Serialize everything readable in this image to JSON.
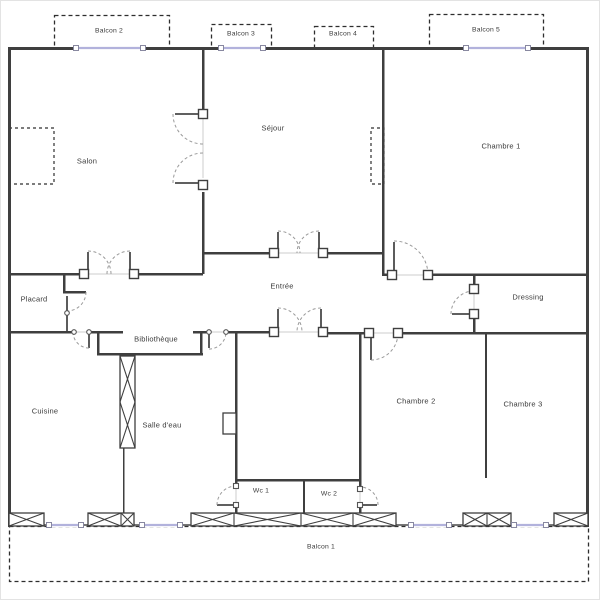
{
  "title": "Plan d'appartement",
  "plan": {
    "colors": {
      "wall": "#3f3f3f",
      "window_blue": "#b2b2dc",
      "dash": "#2e2e2e",
      "arc": "#9a9a9a",
      "thin_opening": "#cccccc",
      "door_leaf": "#4a4a4a",
      "label": "#3a3a3a",
      "jamb_border": "#555555",
      "window_square_border": "#8888a0"
    },
    "labels": [
      {
        "id": "balcon-2",
        "text": "Balcon 2",
        "x": 108,
        "y": 30,
        "small": true
      },
      {
        "id": "balcon-3",
        "text": "Balcon 3",
        "x": 240,
        "y": 33,
        "small": true
      },
      {
        "id": "balcon-4",
        "text": "Balcon 4",
        "x": 342,
        "y": 33,
        "small": true
      },
      {
        "id": "balcon-5",
        "text": "Balcon 5",
        "x": 485,
        "y": 29,
        "small": true
      },
      {
        "id": "salon",
        "text": "Salon",
        "x": 86,
        "y": 160,
        "small": false
      },
      {
        "id": "sejour",
        "text": "Séjour",
        "x": 272,
        "y": 127,
        "small": false
      },
      {
        "id": "chambre-1",
        "text": "Chambre 1",
        "x": 500,
        "y": 145,
        "small": false
      },
      {
        "id": "entree",
        "text": "Entrée",
        "x": 281,
        "y": 285,
        "small": false
      },
      {
        "id": "placard",
        "text": "Placard",
        "x": 33,
        "y": 298,
        "small": false
      },
      {
        "id": "dressing",
        "text": "Dressing",
        "x": 527,
        "y": 296,
        "small": false
      },
      {
        "id": "bibliotheque",
        "text": "Bibliothèque",
        "x": 155,
        "y": 338,
        "small": false
      },
      {
        "id": "cuisine",
        "text": "Cuisine",
        "x": 44,
        "y": 410,
        "small": false
      },
      {
        "id": "salle-deau",
        "text": "Salle d'eau",
        "x": 161,
        "y": 424,
        "small": false
      },
      {
        "id": "chambre-2",
        "text": "Chambre 2",
        "x": 415,
        "y": 400,
        "small": false
      },
      {
        "id": "chambre-3",
        "text": "Chambre 3",
        "x": 522,
        "y": 403,
        "small": false
      },
      {
        "id": "wc-1",
        "text": "Wc 1",
        "x": 260,
        "y": 490,
        "small": true
      },
      {
        "id": "wc-2",
        "text": "Wc 2",
        "x": 328,
        "y": 493,
        "small": true
      },
      {
        "id": "balcon-1",
        "text": "Balcon 1",
        "x": 320,
        "y": 546,
        "small": true
      }
    ],
    "balconies": [
      {
        "id": "balcon-2",
        "x": 53,
        "y": 14,
        "w": 115,
        "h": 33
      },
      {
        "id": "balcon-3",
        "x": 210,
        "y": 23,
        "w": 60,
        "h": 24
      },
      {
        "id": "balcon-4",
        "x": 313,
        "y": 25,
        "w": 59,
        "h": 22
      },
      {
        "id": "balcon-5",
        "x": 428,
        "y": 13,
        "w": 114,
        "h": 34
      },
      {
        "id": "balcon-1",
        "x": 8,
        "y": 525,
        "w": 579,
        "h": 55
      }
    ],
    "dashed_feature_boxes": [
      [
        8,
        127,
        45,
        56
      ],
      [
        370,
        127,
        13,
        56
      ]
    ],
    "solid_boxes": [
      [
        222,
        412,
        13,
        21
      ]
    ],
    "walls": [
      [
        8,
        46,
        580,
        3
      ],
      [
        7,
        46,
        3,
        480
      ],
      [
        585,
        46,
        3,
        480
      ],
      [
        201,
        47,
        2.5,
        61
      ],
      [
        201,
        191,
        2.5,
        82
      ],
      [
        381,
        47,
        2.5,
        228
      ],
      [
        202,
        251,
        71,
        2.5
      ],
      [
        322,
        251,
        60,
        2.5
      ],
      [
        8,
        272,
        75,
        2.5
      ],
      [
        133,
        272,
        69,
        2.5
      ],
      [
        382,
        272.5,
        9,
        2.5
      ],
      [
        427,
        272.5,
        160,
        2.5
      ],
      [
        472,
        274,
        2.5,
        14
      ],
      [
        472,
        313,
        2.5,
        19
      ],
      [
        397,
        331,
        190,
        2.5
      ],
      [
        327,
        331,
        41,
        2.5
      ],
      [
        484,
        332,
        2,
        145
      ],
      [
        8,
        330,
        65,
        2.5
      ],
      [
        88,
        330,
        34,
        2.5
      ],
      [
        96,
        331,
        2.5,
        23
      ],
      [
        96,
        352,
        106,
        2.5
      ],
      [
        199,
        331,
        2.5,
        22
      ],
      [
        192,
        330,
        16,
        2.5
      ],
      [
        225,
        330,
        48,
        2.5
      ],
      [
        62,
        273,
        2.5,
        19
      ],
      [
        62,
        290,
        23,
        2.5
      ],
      [
        234,
        331,
        2.5,
        154
      ],
      [
        234,
        504,
        2.5,
        20
      ],
      [
        234,
        478,
        126,
        2.5
      ],
      [
        358,
        332,
        2.5,
        156
      ],
      [
        358,
        504,
        2.5,
        20
      ],
      [
        302,
        479,
        2,
        45
      ],
      [
        122,
        447,
        1.5,
        77
      ]
    ],
    "thin_openings": [
      [
        202,
        118,
        202,
        177
      ],
      [
        87,
        273,
        129,
        273
      ],
      [
        277,
        252,
        318,
        252
      ],
      [
        277,
        331,
        320,
        331
      ],
      [
        392,
        274,
        427,
        274
      ],
      [
        473,
        289,
        473,
        312
      ],
      [
        369,
        332,
        396,
        332
      ],
      [
        235,
        486,
        235,
        503
      ],
      [
        359,
        489,
        359,
        503
      ],
      [
        73,
        331,
        88,
        331
      ],
      [
        208,
        331,
        225,
        331
      ]
    ],
    "door_leaves": [
      [
        174,
        113,
        200,
        113
      ],
      [
        174,
        182,
        200,
        182
      ],
      [
        87,
        251,
        87,
        272
      ],
      [
        129,
        251,
        129,
        272
      ],
      [
        277,
        231,
        277,
        251
      ],
      [
        318,
        231,
        318,
        251
      ],
      [
        277,
        308,
        277,
        330
      ],
      [
        320,
        308,
        320,
        330
      ],
      [
        393,
        241,
        393,
        273
      ],
      [
        451,
        313,
        472,
        313
      ],
      [
        370,
        333,
        370,
        359
      ],
      [
        88,
        332,
        88,
        347
      ],
      [
        208,
        332,
        208,
        347
      ],
      [
        216,
        504,
        234,
        504
      ],
      [
        360,
        504,
        376,
        504
      ],
      [
        66,
        295,
        66,
        330
      ]
    ],
    "door_arcs": [
      [
        172,
        113,
        202,
        143,
        30,
        0
      ],
      [
        172,
        182,
        202,
        152,
        30,
        1
      ],
      [
        87,
        250,
        110,
        273,
        23,
        1
      ],
      [
        129,
        250,
        106,
        273,
        23,
        0
      ],
      [
        277,
        230,
        299,
        252,
        22,
        1
      ],
      [
        318,
        230,
        296,
        252,
        22,
        0
      ],
      [
        277,
        307,
        301,
        331,
        24,
        1
      ],
      [
        320,
        307,
        296,
        331,
        24,
        0
      ],
      [
        393,
        240,
        427,
        274,
        34,
        1
      ],
      [
        450,
        313,
        473,
        290,
        23,
        1
      ],
      [
        370,
        359,
        397,
        332,
        27,
        0
      ],
      [
        88,
        347,
        72,
        331,
        16,
        1
      ],
      [
        208,
        348,
        225,
        331,
        17,
        0
      ],
      [
        216,
        504,
        235,
        485,
        19,
        1
      ],
      [
        377,
        504,
        359,
        486,
        18,
        0
      ],
      [
        85,
        291,
        66,
        310,
        19,
        1
      ]
    ],
    "jamb_squares_large": [
      [
        202,
        113
      ],
      [
        202,
        184
      ],
      [
        83,
        273
      ],
      [
        133,
        273
      ],
      [
        273,
        252
      ],
      [
        322,
        252
      ],
      [
        273,
        331
      ],
      [
        322,
        331
      ],
      [
        391,
        274
      ],
      [
        427,
        274
      ],
      [
        473,
        288
      ],
      [
        473,
        313
      ],
      [
        368,
        332
      ],
      [
        397,
        332
      ]
    ],
    "jamb_squares_small": [
      [
        235,
        485
      ],
      [
        235,
        504
      ],
      [
        359,
        488
      ],
      [
        359,
        504
      ]
    ],
    "jamb_circles": [
      [
        73,
        331
      ],
      [
        88,
        331
      ],
      [
        208,
        331
      ],
      [
        225,
        331
      ],
      [
        66,
        312
      ]
    ],
    "blue_windows": [
      [
        75,
        142,
        47
      ],
      [
        220,
        262,
        47
      ],
      [
        465,
        527,
        47
      ],
      [
        48,
        80,
        524
      ],
      [
        141,
        179,
        524
      ],
      [
        410,
        448,
        524
      ],
      [
        513,
        545,
        524
      ]
    ],
    "window_boxes": [
      {
        "x": 8,
        "y": 512,
        "w": 35,
        "h": 13,
        "dividers": []
      },
      {
        "x": 87,
        "y": 512,
        "w": 46,
        "h": 13,
        "dividers": [
          120
        ]
      },
      {
        "x": 190,
        "y": 512,
        "w": 205,
        "h": 13,
        "dividers": [
          233,
          300,
          352
        ]
      },
      {
        "x": 462,
        "y": 512,
        "w": 48,
        "h": 13,
        "dividers": [
          486
        ]
      },
      {
        "x": 553,
        "y": 512,
        "w": 34,
        "h": 13,
        "dividers": []
      }
    ],
    "x_column": {
      "x": 119,
      "y": 355,
      "w": 15,
      "h": 92,
      "dividers_y": [
        401
      ]
    },
    "bottom_wall_line": [
      8,
      524,
      587,
      524
    ]
  }
}
